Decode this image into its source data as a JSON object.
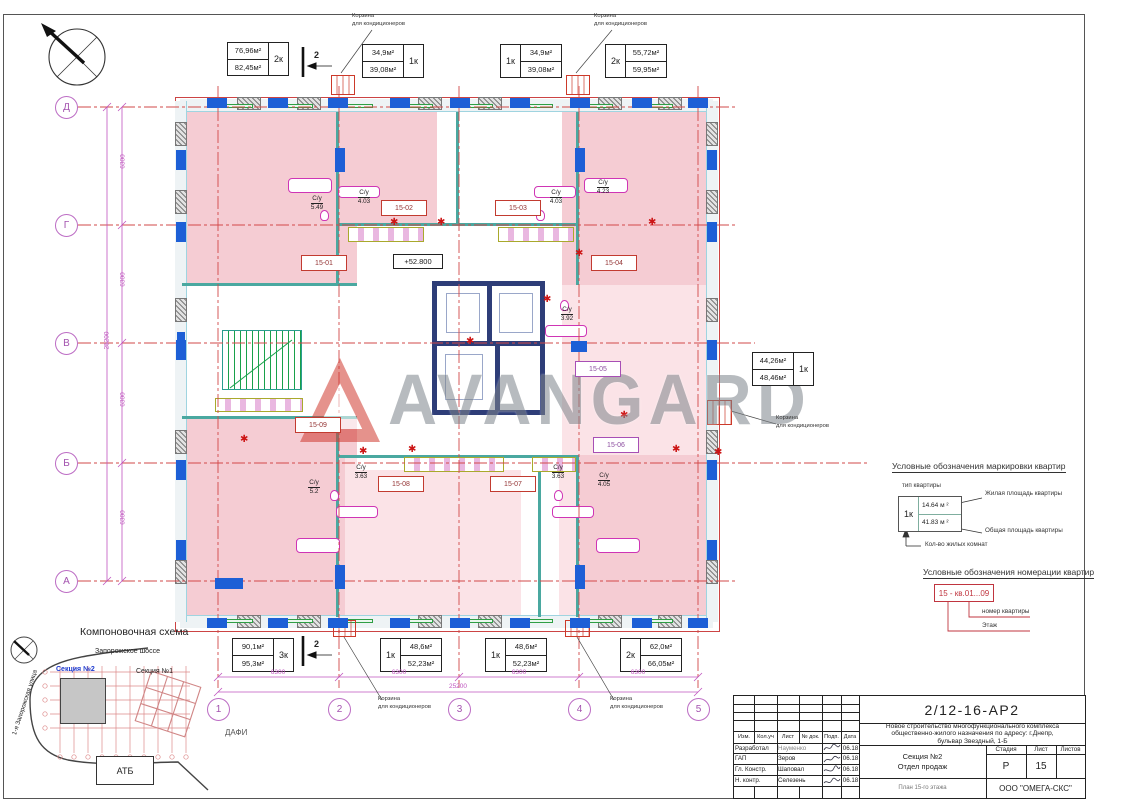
{
  "watermark": {
    "text": "AVANGARD"
  },
  "plan": {
    "elevation_mark": "+52.800",
    "section_mark": "2",
    "basket": {
      "line1": "Корзина",
      "line2": "для кондиционеров"
    },
    "apartments": [
      "15-01",
      "15-02",
      "15-03",
      "15-04",
      "15-05",
      "15-06",
      "15-07",
      "15-08",
      "15-09"
    ],
    "bathrooms": [
      {
        "label": "С/у",
        "area": "5.49"
      },
      {
        "label": "С/у",
        "area": "4.03"
      },
      {
        "label": "С/у",
        "area": "4.03"
      },
      {
        "label": "С/у",
        "area": "4.23"
      },
      {
        "label": "С/у",
        "area": "3.92"
      },
      {
        "label": "С/у",
        "area": "5.2"
      },
      {
        "label": "С/у",
        "area": "3.63"
      },
      {
        "label": "С/у",
        "area": "3.63"
      },
      {
        "label": "С/у",
        "area": "4.05"
      }
    ],
    "axes": {
      "cols": [
        "1",
        "2",
        "3",
        "4",
        "5"
      ],
      "rows": [
        "Д",
        "Г",
        "В",
        "Б",
        "А"
      ]
    },
    "dims": {
      "col_segments": [
        "6300",
        "6300",
        "6300",
        "6300"
      ],
      "col_total": "25200",
      "row_segments": [
        "6300",
        "6300",
        "6300",
        "6300"
      ],
      "row_total": "25200"
    },
    "area_tags": {
      "top": [
        {
          "living": "76,96м²",
          "total": "82,45м²",
          "rooms": "2к"
        },
        {
          "living": "34,9м²",
          "total": "39,08м²",
          "rooms": "1к"
        },
        {
          "living": "34,9м²",
          "total": "39,08м²",
          "rooms": "1к"
        },
        {
          "living": "55,72м²",
          "total": "59,95м²",
          "rooms": "2к"
        }
      ],
      "bottom": [
        {
          "living": "90,1м²",
          "total": "95,3м²",
          "rooms": "3к"
        },
        {
          "living": "48,6м²",
          "total": "52,23м²",
          "rooms": "1к"
        },
        {
          "living": "48,6м²",
          "total": "52,23м²",
          "rooms": "1к"
        },
        {
          "living": "62,0м²",
          "total": "66,05м²",
          "rooms": "2к"
        }
      ],
      "right": [
        {
          "living": "44,26м²",
          "total": "48,46м²",
          "rooms": "1к"
        }
      ]
    }
  },
  "legend_marking": {
    "title": "Условные обозначения маркировки квартир",
    "type_label": "тип квартиры",
    "example_rooms": "1к",
    "example_living": "14.64 м ²",
    "example_total": "41.83 м ²",
    "living_label": "Жилая площадь квартиры",
    "total_label": "Общая площадь квартиры",
    "rooms_label": "Кол-во жилых комнат"
  },
  "legend_numbering": {
    "title": "Условные обозначения номерации квартир",
    "example": "15 - кв.01...09",
    "number_label": "номер квартиры",
    "floor_label": "Этаж"
  },
  "scheme": {
    "title": "Компоновочная схема",
    "road": "Запорожское шоссе",
    "section2": "Секция №2",
    "section1": "Секция №1",
    "atb": "АТБ",
    "street": "1-я Запорожская улица",
    "dafi": "ДАФИ"
  },
  "titleblock": {
    "doc_number": "2/12-16-АР2",
    "description_lines": [
      "Новое строительство многофункционального комплекса",
      "общественно-жилого назначения по адресу: г.Днепр,",
      "бульвар Звездный, 1-Б"
    ],
    "header_cols": [
      "Изм.",
      "Кол.уч",
      "Лист",
      "№ док.",
      "Подп.",
      "Дата"
    ],
    "rows": [
      {
        "role": "Разработал",
        "name": "Науменко",
        "date": "06.18"
      },
      {
        "role": "ГАП",
        "name": "Зеров",
        "date": "06.18"
      },
      {
        "role": "Гл. Констр.",
        "name": "Шаповал",
        "date": "06.18"
      },
      {
        "role": "Н. контр.",
        "name": "Селезень",
        "date": "06.18"
      }
    ],
    "section_line1": "Секция №2",
    "section_line2": "Отдел продаж",
    "stage_label": "Стадия",
    "sheet_label": "Лист",
    "sheets_label": "Листов",
    "stage_value": "Р",
    "sheet_value": "15",
    "sheets_value": "",
    "plan_title": "План 15-го этажа",
    "company": "ООО \"ОМЕГА-СКС\""
  }
}
